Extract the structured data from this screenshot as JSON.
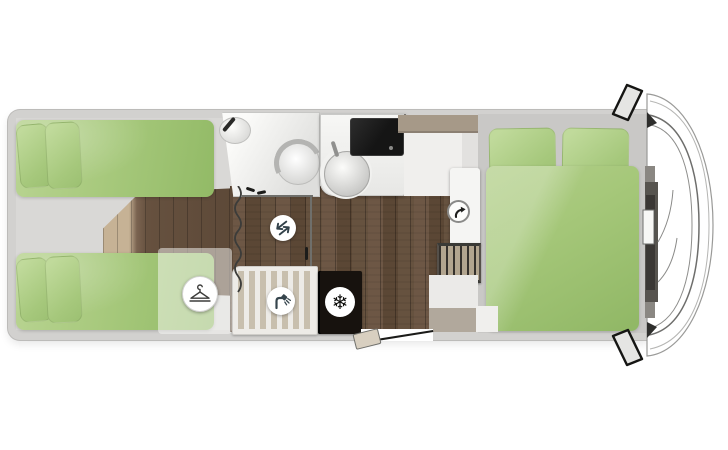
{
  "scene": {
    "description": "Motorhome floor plan, top view, driver cab on the right",
    "areas": {
      "rear_twin_beds": "two rear single beds with green bedding",
      "wardrobe": "wardrobe over rear bed foot",
      "bathroom": "washroom with basin and toilet",
      "shower": "shower cubicle with slatted tray",
      "kitchen": "kitchenette with round sink and hob",
      "fridge": "refrigerator",
      "front_bed": "double bed with two pillows",
      "cab": "driver cab with wing mirrors",
      "entry": "entry door with fold-out step"
    }
  },
  "icons": {
    "wardrobe": {
      "name": "hanger-icon"
    },
    "shower": {
      "name": "shower-head-icon"
    },
    "door_swing": {
      "name": "swap-arrows-icon"
    },
    "swivel": {
      "name": "rotate-arrow-icon"
    },
    "fridge": {
      "name": "snowflake-icon",
      "glyph": "❄"
    }
  },
  "colors": {
    "bedding_green": "#a3c677",
    "floor_wood_dark": "#624e3d",
    "floor_wood_light": "#c6b295",
    "shell_gray": "#d2d1cf",
    "room_gray": "#d9d8d6",
    "bed_base_gray": "#c9c8c6",
    "appliance_black": "#17120e",
    "icon_ink": "#36454d",
    "overhead_taupe": "#a69988"
  }
}
